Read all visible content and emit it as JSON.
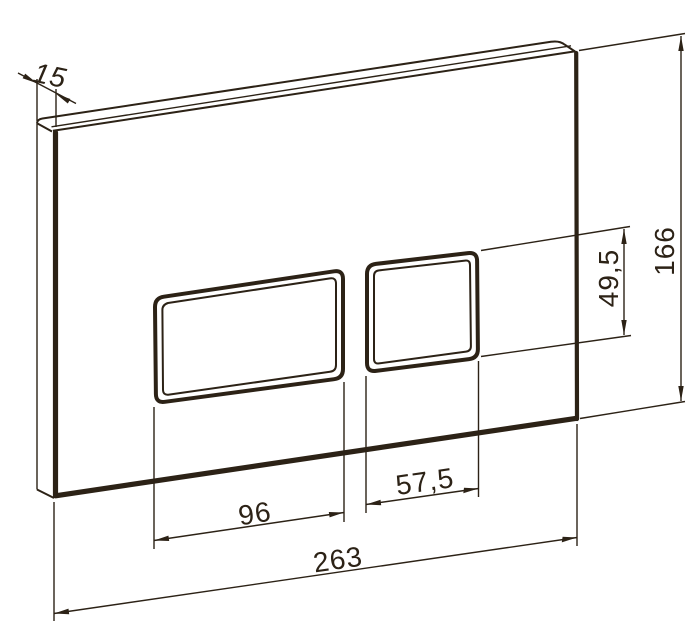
{
  "drawing": {
    "subject": "perspective technical drawing of a rectangular plate with two rectangular buttons",
    "dimensions": {
      "thickness": "15",
      "height": "166",
      "button_height": "49,5",
      "left_button_width": "96",
      "right_button_width": "57,5",
      "width": "263"
    },
    "colors": {
      "line": "#2c2216",
      "background": "#ffffff"
    }
  }
}
